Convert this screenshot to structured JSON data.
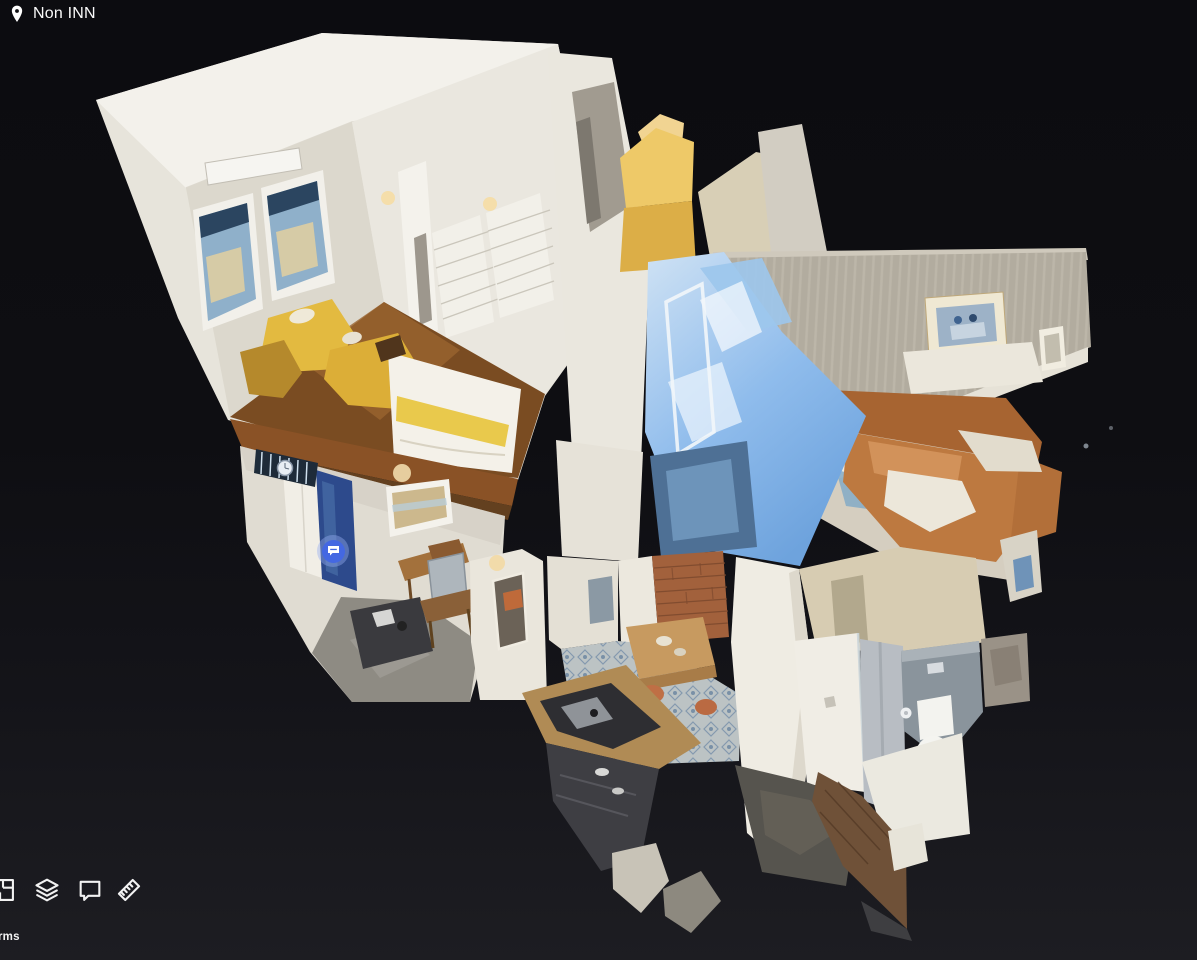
{
  "header": {
    "title": "Non INN"
  },
  "scene": {
    "type": "3d-dollhouse-tour",
    "rooms": [
      {
        "name": "bedroom"
      },
      {
        "name": "entry-hallway"
      },
      {
        "name": "glass-bathroom"
      },
      {
        "name": "living-room"
      },
      {
        "name": "dining-area"
      },
      {
        "name": "kitchen"
      },
      {
        "name": "shower-room"
      },
      {
        "name": "toilet-room"
      }
    ],
    "mattertag": {
      "icon": "comment-bubble",
      "color": "#4468e2"
    }
  },
  "toolbar": {
    "buttons": [
      {
        "id": "floorplan",
        "icon": "floorplan-icon"
      },
      {
        "id": "layers",
        "icon": "layers-icon"
      },
      {
        "id": "comments",
        "icon": "comment-icon"
      },
      {
        "id": "measure",
        "icon": "ruler-icon"
      }
    ]
  },
  "footer": {
    "terms_label": "Terms"
  },
  "theme": {
    "background_top": "#0c0c10",
    "background_bottom": "#1d1d22",
    "text": "#f5f5f5",
    "tag_blue": "#4468e2"
  }
}
